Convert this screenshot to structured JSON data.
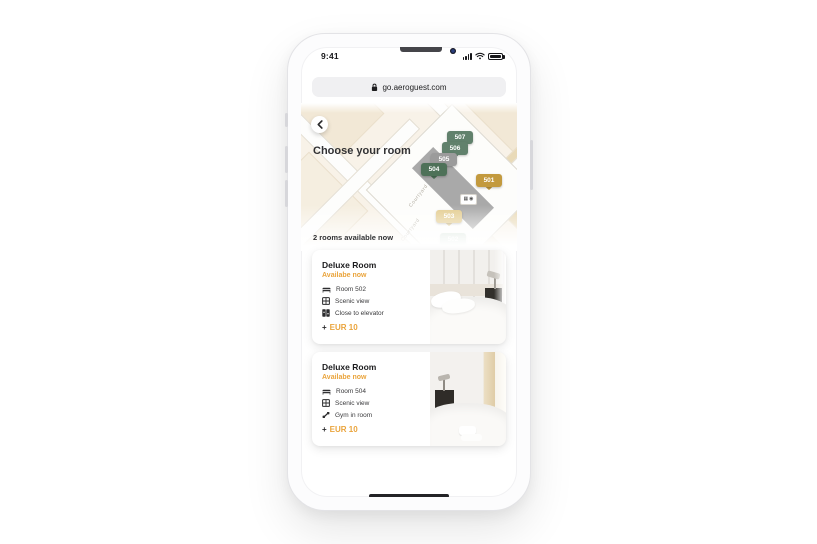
{
  "colors": {
    "accent_gold": "#EAA43C",
    "pin_green": "#61816C",
    "pin_green_dark": "#4E7158",
    "pin_gray": "#9B9B9B",
    "pin_gold": "#C39A3E",
    "pin_tan": "#E3CC8F",
    "pin_faded_green": "#9DBBA6"
  },
  "status_bar": {
    "time": "9:41"
  },
  "browser_bar": {
    "url": "go.aeroguest.com"
  },
  "map_section": {
    "title": "Choose your room",
    "street_label_1": "Courtyard",
    "street_label_2": "Courtyard",
    "pins": [
      {
        "label": "507",
        "color": "#61816C"
      },
      {
        "label": "506",
        "color": "#61816C"
      },
      {
        "label": "505",
        "color": "#9B9B9B"
      },
      {
        "label": "504",
        "color": "#4E7158"
      },
      {
        "label": "501",
        "color": "#C39A3E"
      },
      {
        "label": "503",
        "color": "#E3CC8F"
      },
      {
        "label": "502",
        "color": "#9DBBA6"
      }
    ]
  },
  "availability": {
    "summary": "2 rooms available now"
  },
  "cards": [
    {
      "title": "Deluxe Room",
      "status": "Availabe now",
      "features": [
        {
          "icon": "bed-icon",
          "label": "Room 502"
        },
        {
          "icon": "window-icon",
          "label": "Scenic view"
        },
        {
          "icon": "elevator-icon",
          "label": "Close to elevator"
        }
      ],
      "price_prefix": "+",
      "price": "EUR 10"
    },
    {
      "title": "Deluxe Room",
      "status": "Availabe now",
      "features": [
        {
          "icon": "bed-icon",
          "label": "Room 504"
        },
        {
          "icon": "window-icon",
          "label": "Scenic view"
        },
        {
          "icon": "gym-icon",
          "label": "Gym in room"
        }
      ],
      "price_prefix": "+",
      "price": "EUR 10"
    }
  ]
}
